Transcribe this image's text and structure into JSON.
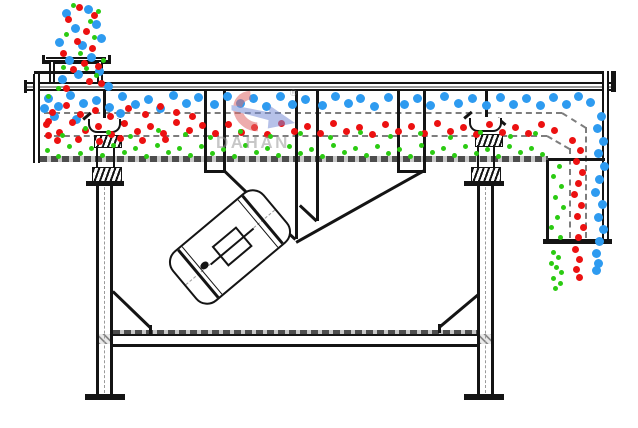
{
  "diagram": {
    "type": "linear-vibrating-screen-cross-section",
    "watermark": {
      "brand": "DAHAN",
      "registered_mark": "®"
    },
    "particle_colors": {
      "blue": "#2e9bf0",
      "red": "#ec1111",
      "green": "#2bcb12"
    },
    "particle_sizes": {
      "blue": 9,
      "red": 7,
      "green": 5
    },
    "particles": {
      "blue": [
        [
          66,
          13
        ],
        [
          88,
          9
        ],
        [
          75,
          28
        ],
        [
          96,
          24
        ],
        [
          59,
          42
        ],
        [
          82,
          45
        ],
        [
          101,
          38
        ],
        [
          69,
          60
        ],
        [
          91,
          57
        ],
        [
          78,
          74
        ],
        [
          62,
          79
        ],
        [
          99,
          71
        ],
        [
          108,
          86
        ],
        [
          48,
          98
        ],
        [
          58,
          106
        ],
        [
          70,
          95
        ],
        [
          83,
          103
        ],
        [
          96,
          100
        ],
        [
          109,
          107
        ],
        [
          122,
          96
        ],
        [
          135,
          104
        ],
        [
          148,
          99
        ],
        [
          160,
          108
        ],
        [
          173,
          95
        ],
        [
          186,
          103
        ],
        [
          198,
          97
        ],
        [
          214,
          104
        ],
        [
          227,
          96
        ],
        [
          240,
          103
        ],
        [
          253,
          98
        ],
        [
          266,
          106
        ],
        [
          280,
          96
        ],
        [
          292,
          104
        ],
        [
          305,
          99
        ],
        [
          322,
          105
        ],
        [
          335,
          96
        ],
        [
          348,
          103
        ],
        [
          360,
          98
        ],
        [
          374,
          106
        ],
        [
          388,
          97
        ],
        [
          404,
          104
        ],
        [
          417,
          98
        ],
        [
          430,
          105
        ],
        [
          444,
          96
        ],
        [
          458,
          103
        ],
        [
          472,
          98
        ],
        [
          486,
          105
        ],
        [
          500,
          97
        ],
        [
          513,
          104
        ],
        [
          526,
          98
        ],
        [
          540,
          105
        ],
        [
          553,
          97
        ],
        [
          566,
          104
        ],
        [
          578,
          96
        ],
        [
          590,
          102
        ],
        [
          54,
          116
        ],
        [
          76,
          119
        ],
        [
          120,
          113
        ],
        [
          44,
          108
        ],
        [
          601,
          116
        ],
        [
          597,
          128
        ],
        [
          603,
          141
        ],
        [
          598,
          153
        ],
        [
          604,
          166
        ],
        [
          599,
          179
        ],
        [
          595,
          192
        ],
        [
          602,
          204
        ],
        [
          598,
          217
        ],
        [
          603,
          229
        ],
        [
          599,
          241
        ],
        [
          596,
          253
        ],
        [
          598,
          263
        ],
        [
          596,
          270
        ]
      ],
      "red": [
        [
          79,
          7
        ],
        [
          94,
          15
        ],
        [
          68,
          19
        ],
        [
          86,
          31
        ],
        [
          77,
          41
        ],
        [
          63,
          53
        ],
        [
          92,
          48
        ],
        [
          84,
          63
        ],
        [
          98,
          66
        ],
        [
          73,
          69
        ],
        [
          89,
          81
        ],
        [
          66,
          88
        ],
        [
          101,
          83
        ],
        [
          52,
          112
        ],
        [
          66,
          105
        ],
        [
          80,
          114
        ],
        [
          95,
          110
        ],
        [
          110,
          116
        ],
        [
          128,
          108
        ],
        [
          145,
          114
        ],
        [
          160,
          106
        ],
        [
          176,
          112
        ],
        [
          192,
          116
        ],
        [
          48,
          121
        ],
        [
          57,
          140
        ],
        [
          78,
          139
        ],
        [
          99,
          141
        ],
        [
          120,
          138
        ],
        [
          142,
          140
        ],
        [
          165,
          139
        ],
        [
          48,
          135
        ],
        [
          46,
          124
        ],
        [
          59,
          132
        ],
        [
          72,
          122
        ],
        [
          85,
          130
        ],
        [
          98,
          126
        ],
        [
          111,
          134
        ],
        [
          124,
          123
        ],
        [
          137,
          131
        ],
        [
          150,
          126
        ],
        [
          163,
          133
        ],
        [
          176,
          122
        ],
        [
          189,
          130
        ],
        [
          202,
          125
        ],
        [
          215,
          133
        ],
        [
          228,
          124
        ],
        [
          241,
          132
        ],
        [
          254,
          127
        ],
        [
          267,
          134
        ],
        [
          281,
          123
        ],
        [
          294,
          131
        ],
        [
          307,
          126
        ],
        [
          320,
          133
        ],
        [
          333,
          123
        ],
        [
          346,
          131
        ],
        [
          359,
          127
        ],
        [
          372,
          134
        ],
        [
          385,
          124
        ],
        [
          398,
          131
        ],
        [
          411,
          126
        ],
        [
          424,
          133
        ],
        [
          437,
          123
        ],
        [
          450,
          131
        ],
        [
          463,
          127
        ],
        [
          476,
          134
        ],
        [
          489,
          124
        ],
        [
          502,
          132
        ],
        [
          515,
          127
        ],
        [
          528,
          133
        ],
        [
          541,
          124
        ],
        [
          554,
          130
        ],
        [
          572,
          140
        ],
        [
          580,
          150
        ],
        [
          576,
          161
        ],
        [
          582,
          172
        ],
        [
          578,
          183
        ],
        [
          574,
          194
        ],
        [
          581,
          205
        ],
        [
          577,
          216
        ],
        [
          583,
          227
        ],
        [
          578,
          237
        ],
        [
          575,
          249
        ],
        [
          579,
          259
        ],
        [
          576,
          269
        ],
        [
          579,
          277
        ]
      ],
      "green": [
        [
          73,
          5
        ],
        [
          98,
          11
        ],
        [
          90,
          21
        ],
        [
          66,
          34
        ],
        [
          94,
          37
        ],
        [
          80,
          53
        ],
        [
          63,
          67
        ],
        [
          96,
          75
        ],
        [
          86,
          68
        ],
        [
          103,
          60
        ],
        [
          58,
          88
        ],
        [
          48,
          96
        ],
        [
          62,
          135
        ],
        [
          85,
          128
        ],
        [
          108,
          132
        ],
        [
          130,
          136
        ],
        [
          158,
          130
        ],
        [
          185,
          134
        ],
        [
          210,
          137
        ],
        [
          240,
          131
        ],
        [
          270,
          136
        ],
        [
          300,
          133
        ],
        [
          330,
          137
        ],
        [
          360,
          132
        ],
        [
          390,
          136
        ],
        [
          420,
          133
        ],
        [
          450,
          137
        ],
        [
          480,
          132
        ],
        [
          510,
          136
        ],
        [
          535,
          133
        ],
        [
          47,
          150
        ],
        [
          58,
          156
        ],
        [
          69,
          146
        ],
        [
          80,
          153
        ],
        [
          91,
          148
        ],
        [
          102,
          155
        ],
        [
          113,
          145
        ],
        [
          124,
          152
        ],
        [
          135,
          148
        ],
        [
          146,
          156
        ],
        [
          157,
          145
        ],
        [
          168,
          152
        ],
        [
          179,
          148
        ],
        [
          190,
          155
        ],
        [
          201,
          146
        ],
        [
          212,
          153
        ],
        [
          223,
          149
        ],
        [
          234,
          156
        ],
        [
          245,
          145
        ],
        [
          256,
          152
        ],
        [
          267,
          148
        ],
        [
          278,
          155
        ],
        [
          289,
          146
        ],
        [
          300,
          153
        ],
        [
          311,
          149
        ],
        [
          322,
          156
        ],
        [
          333,
          145
        ],
        [
          344,
          152
        ],
        [
          355,
          148
        ],
        [
          366,
          155
        ],
        [
          377,
          146
        ],
        [
          388,
          153
        ],
        [
          399,
          149
        ],
        [
          410,
          156
        ],
        [
          421,
          145
        ],
        [
          432,
          152
        ],
        [
          443,
          148
        ],
        [
          454,
          155
        ],
        [
          465,
          146
        ],
        [
          476,
          153
        ],
        [
          487,
          149
        ],
        [
          498,
          156
        ],
        [
          509,
          146
        ],
        [
          520,
          152
        ],
        [
          531,
          148
        ],
        [
          542,
          154
        ],
        [
          559,
          166
        ],
        [
          553,
          176
        ],
        [
          561,
          186
        ],
        [
          555,
          197
        ],
        [
          563,
          207
        ],
        [
          557,
          217
        ],
        [
          551,
          227
        ],
        [
          560,
          237
        ],
        [
          553,
          252
        ],
        [
          558,
          257
        ],
        [
          551,
          263
        ],
        [
          556,
          267
        ],
        [
          561,
          272
        ],
        [
          553,
          278
        ],
        [
          560,
          283
        ],
        [
          555,
          288
        ]
      ]
    }
  }
}
